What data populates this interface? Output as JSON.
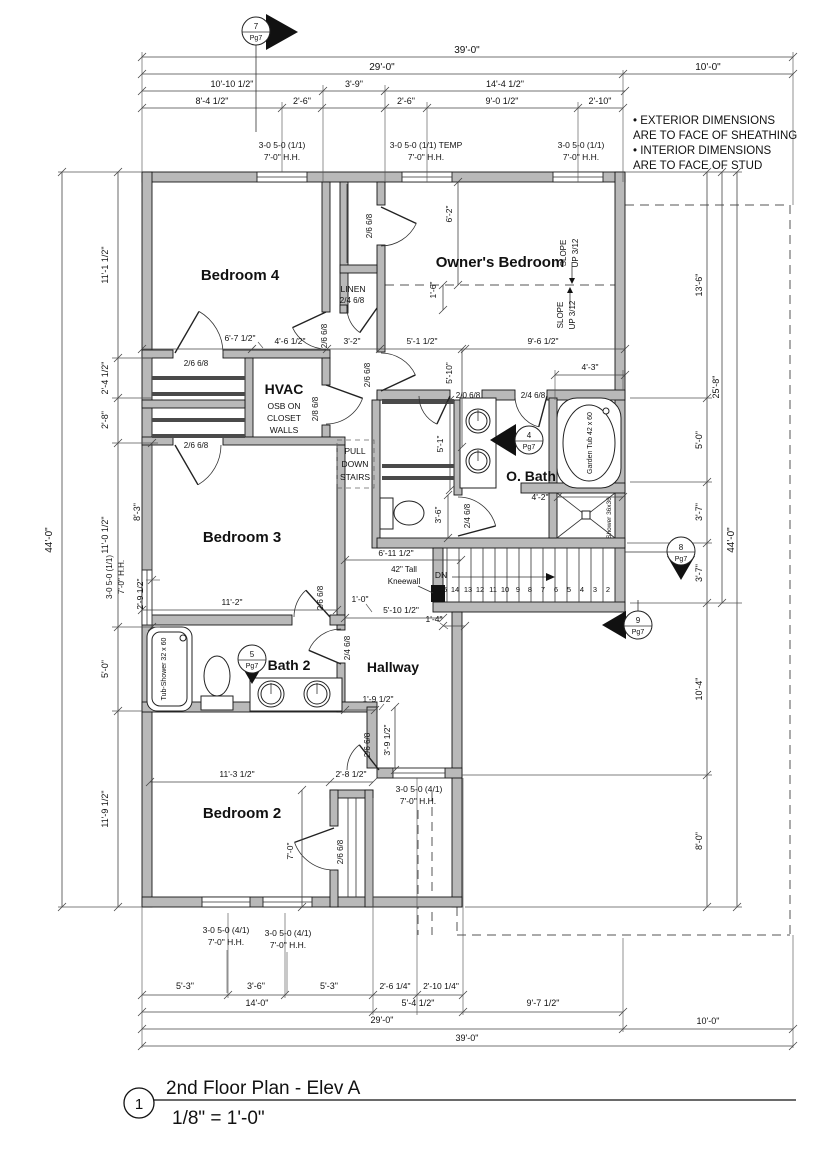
{
  "sheet": {
    "drawing_type": "architectural floor plan",
    "accent_wall_color": "#b9b9b9",
    "line_color": "#222222"
  },
  "labels": {
    "title_block": [
      {
        "n": "detail-number",
        "t": "1",
        "x": 139,
        "y": 1109,
        "s": 15
      },
      {
        "n": "drawing-title",
        "t": "2nd Floor Plan - Elev A",
        "x": 166,
        "y": 1094,
        "s": 19,
        "a": "s"
      },
      {
        "n": "drawing-scale",
        "t": "1/8\" = 1'-0\"",
        "x": 172,
        "y": 1124,
        "s": 19,
        "a": "s"
      }
    ],
    "notes": [
      {
        "n": "note-line",
        "t": "• EXTERIOR DIMENSIONS",
        "x": 633,
        "y": 124,
        "s": 11.5,
        "a": "s"
      },
      {
        "n": "note-line",
        "t": "ARE TO FACE OF SHEATHING",
        "x": 633,
        "y": 139,
        "s": 11.5,
        "a": "s"
      },
      {
        "n": "note-line",
        "t": "• INTERIOR DIMENSIONS",
        "x": 633,
        "y": 154,
        "s": 11.5,
        "a": "s"
      },
      {
        "n": "note-line",
        "t": "ARE TO FACE OF STUD",
        "x": 633,
        "y": 169,
        "s": 11.5,
        "a": "s"
      }
    ],
    "rooms": [
      {
        "n": "room-label-bedroom-4",
        "t": "Bedroom 4",
        "x": 240,
        "y": 280,
        "s": 15,
        "b": 1
      },
      {
        "n": "room-label-owners-bedroom",
        "t": "Owner's Bedroom",
        "x": 500,
        "y": 267,
        "s": 15,
        "b": 1
      },
      {
        "n": "room-label-bedroom-3",
        "t": "Bedroom 3",
        "x": 242,
        "y": 542,
        "s": 15,
        "b": 1
      },
      {
        "n": "room-label-bedroom-2",
        "t": "Bedroom 2",
        "x": 242,
        "y": 818,
        "s": 15,
        "b": 1
      },
      {
        "n": "room-label-owners-bath",
        "t": "O. Bath",
        "x": 531,
        "y": 481,
        "s": 14,
        "b": 1
      },
      {
        "n": "room-label-bath-2",
        "t": "Bath 2",
        "x": 289,
        "y": 670,
        "s": 14,
        "b": 1
      },
      {
        "n": "room-label-hallway",
        "t": "Hallway",
        "x": 393,
        "y": 672,
        "s": 14,
        "b": 1
      },
      {
        "n": "room-label-linen",
        "t": "LINEN",
        "x": 353,
        "y": 292,
        "s": 8.5
      },
      {
        "n": "room-label-hvac",
        "t": "HVAC",
        "x": 284,
        "y": 394,
        "s": 14,
        "b": 1
      },
      {
        "n": "hvac-note",
        "t": "OSB ON",
        "x": 284,
        "y": 409,
        "s": 8.5
      },
      {
        "n": "hvac-note",
        "t": "CLOSET",
        "x": 284,
        "y": 421,
        "s": 8.5
      },
      {
        "n": "hvac-note",
        "t": "WALLS",
        "x": 284,
        "y": 433,
        "s": 8.5
      },
      {
        "n": "pull-down-stairs-note",
        "t": "PULL",
        "x": 355,
        "y": 454,
        "s": 8.5
      },
      {
        "n": "pull-down-stairs-note",
        "t": "DOWN",
        "x": 355,
        "y": 467,
        "s": 8.5
      },
      {
        "n": "pull-down-stairs-note",
        "t": "STAIRS",
        "x": 355,
        "y": 480,
        "s": 8.5
      }
    ],
    "fixtures": [
      {
        "n": "fixture-label-garden-tub",
        "t": "Garden Tub 42 x 60",
        "x": 592,
        "y": 443,
        "r": -90,
        "s": 7
      },
      {
        "n": "fixture-label-shower",
        "t": "Shower 36x36",
        "x": 611,
        "y": 518,
        "r": -90,
        "s": 6.5
      },
      {
        "n": "fixture-label-tub-shower",
        "t": "Tub-Shower 32 x 60",
        "x": 166,
        "y": 669,
        "r": -90,
        "s": 7
      }
    ],
    "dims_top": [
      {
        "n": "dimension-label",
        "t": "39'-0\"",
        "x": 467,
        "y": 53,
        "s": 10
      },
      {
        "n": "dimension-label",
        "t": "29'-0\"",
        "x": 382,
        "y": 70,
        "s": 10
      },
      {
        "n": "dimension-label",
        "t": "10'-0\"",
        "x": 708,
        "y": 70,
        "s": 10
      },
      {
        "n": "dimension-label",
        "t": "10'-10 1/2\"",
        "x": 232,
        "y": 87
      },
      {
        "n": "dimension-label",
        "t": "3'-9\"",
        "x": 354,
        "y": 87
      },
      {
        "n": "dimension-label",
        "t": "14'-4 1/2\"",
        "x": 505,
        "y": 87
      },
      {
        "n": "dimension-label",
        "t": "8'-4 1/2\"",
        "x": 212,
        "y": 104
      },
      {
        "n": "dimension-label",
        "t": "2'-6\"",
        "x": 302,
        "y": 104
      },
      {
        "n": "dimension-label",
        "t": "2'-6\"",
        "x": 406,
        "y": 104
      },
      {
        "n": "dimension-label",
        "t": "9'-0 1/2\"",
        "x": 502,
        "y": 104
      },
      {
        "n": "dimension-label",
        "t": "2'-10\"",
        "x": 600,
        "y": 104
      }
    ],
    "dims_bottom": [
      {
        "n": "dimension-label",
        "t": "5'-3\"",
        "x": 185,
        "y": 989
      },
      {
        "n": "dimension-label",
        "t": "3'-6\"",
        "x": 256,
        "y": 989
      },
      {
        "n": "dimension-label",
        "t": "5'-3\"",
        "x": 329,
        "y": 989
      },
      {
        "n": "dimension-label",
        "t": "2'-6 1/4\"",
        "x": 395,
        "y": 989,
        "s": 8.5
      },
      {
        "n": "dimension-label",
        "t": "2'-10 1/4\"",
        "x": 441,
        "y": 989,
        "s": 8.5
      },
      {
        "n": "dimension-label",
        "t": "14'-0\"",
        "x": 257,
        "y": 1006
      },
      {
        "n": "dimension-label",
        "t": "5'-4 1/2\"",
        "x": 418,
        "y": 1006
      },
      {
        "n": "dimension-label",
        "t": "9'-7 1/2\"",
        "x": 543,
        "y": 1006
      },
      {
        "n": "dimension-label",
        "t": "29'-0\"",
        "x": 382,
        "y": 1023
      },
      {
        "n": "dimension-label",
        "t": "10'-0\"",
        "x": 708,
        "y": 1024
      },
      {
        "n": "dimension-label",
        "t": "39'-0\"",
        "x": 467,
        "y": 1041
      }
    ],
    "dims_left": [
      {
        "n": "dimension-label",
        "t": "44'-0\"",
        "x": 52,
        "y": 540,
        "r": -90,
        "s": 10
      },
      {
        "n": "dimension-label",
        "t": "11'-1 1/2\"",
        "x": 108,
        "y": 265,
        "r": -90
      },
      {
        "n": "dimension-label",
        "t": "2'-4 1/2\"",
        "x": 108,
        "y": 378,
        "r": -90
      },
      {
        "n": "dimension-label",
        "t": "2'-8\"",
        "x": 108,
        "y": 420,
        "r": -90
      },
      {
        "n": "dimension-label",
        "t": "11'-0 1/2\"",
        "x": 108,
        "y": 535,
        "r": -90
      },
      {
        "n": "dimension-label",
        "t": "8'-3\"",
        "x": 140,
        "y": 512,
        "r": -90
      },
      {
        "n": "dimension-label",
        "t": "2'-9 1/2\"",
        "x": 143,
        "y": 594,
        "r": -90,
        "s": 8.5
      },
      {
        "n": "dimension-label",
        "t": "5'-0\"",
        "x": 108,
        "y": 669,
        "r": -90
      },
      {
        "n": "dimension-label",
        "t": "11'-9 1/2\"",
        "x": 108,
        "y": 809,
        "r": -90
      }
    ],
    "dims_right": [
      {
        "n": "dimension-label",
        "t": "13'-6\"",
        "x": 702,
        "y": 285,
        "r": -90
      },
      {
        "n": "dimension-label",
        "t": "25'-8\"",
        "x": 719,
        "y": 387,
        "r": -90
      },
      {
        "n": "dimension-label",
        "t": "44'-0\"",
        "x": 734,
        "y": 540,
        "r": -90,
        "s": 10
      },
      {
        "n": "dimension-label",
        "t": "5'-0\"",
        "x": 702,
        "y": 440,
        "r": -90
      },
      {
        "n": "dimension-label",
        "t": "3'-7\"",
        "x": 702,
        "y": 512,
        "r": -90
      },
      {
        "n": "dimension-label",
        "t": "3'-7\"",
        "x": 702,
        "y": 573,
        "r": -90
      },
      {
        "n": "dimension-label",
        "t": "10'-4\"",
        "x": 702,
        "y": 689,
        "r": -90
      },
      {
        "n": "dimension-label",
        "t": "8'-0\"",
        "x": 702,
        "y": 841,
        "r": -90
      }
    ],
    "dims_interior": [
      {
        "n": "dimension-label",
        "t": "6'-2\"",
        "x": 452,
        "y": 214,
        "r": -90,
        "s": 8.5
      },
      {
        "n": "dimension-label",
        "t": "1'-6\"",
        "x": 436,
        "y": 290,
        "r": -90,
        "s": 8.5
      },
      {
        "n": "dimension-label",
        "t": "6'-7 1/2\"",
        "x": 240,
        "y": 341,
        "s": 8.5
      },
      {
        "n": "dimension-label",
        "t": "4'-6 1/2\"",
        "x": 290,
        "y": 344,
        "s": 8.5
      },
      {
        "n": "dimension-label",
        "t": "3'-2\"",
        "x": 352,
        "y": 344,
        "s": 8.5
      },
      {
        "n": "dimension-label",
        "t": "5'-1 1/2\"",
        "x": 422,
        "y": 344,
        "s": 8.5
      },
      {
        "n": "dimension-label",
        "t": "9'-6 1/2\"",
        "x": 543,
        "y": 344,
        "s": 8.5
      },
      {
        "n": "dimension-label",
        "t": "4'-3\"",
        "x": 590,
        "y": 370,
        "s": 8.5
      },
      {
        "n": "dimension-label",
        "t": "5'-10\"",
        "x": 452,
        "y": 373,
        "r": -90,
        "s": 8.5
      },
      {
        "n": "dimension-label",
        "t": "5'-1\"",
        "x": 443,
        "y": 444,
        "r": -90,
        "s": 8.5
      },
      {
        "n": "dimension-label",
        "t": "3'-6\"",
        "x": 441,
        "y": 515,
        "r": -90,
        "s": 8.5
      },
      {
        "n": "dimension-label",
        "t": "4'-2\"",
        "x": 540,
        "y": 500,
        "s": 8.5
      },
      {
        "n": "dimension-label",
        "t": "11'-2\"",
        "x": 232,
        "y": 605,
        "s": 8.5
      },
      {
        "n": "dimension-label",
        "t": "1'-0\"",
        "x": 360,
        "y": 602,
        "s": 8.5
      },
      {
        "n": "dimension-label",
        "t": "5'-10 1/2\"",
        "x": 401,
        "y": 613,
        "s": 8.5
      },
      {
        "n": "dimension-label",
        "t": "1'-4\"",
        "x": 434,
        "y": 622,
        "s": 8.5
      },
      {
        "n": "dimension-label",
        "t": "6'-11 1/2\"",
        "x": 396,
        "y": 556,
        "s": 8.5
      },
      {
        "n": "dimension-label",
        "t": "1'-9 1/2\"",
        "x": 378,
        "y": 702,
        "s": 8.5
      },
      {
        "n": "dimension-label",
        "t": "3'-9 1/2\"",
        "x": 390,
        "y": 740,
        "r": -90,
        "s": 8.5
      },
      {
        "n": "dimension-label",
        "t": "2'-8 1/2\"",
        "x": 351,
        "y": 777,
        "s": 8.5
      },
      {
        "n": "dimension-label",
        "t": "11'-3 1/2\"",
        "x": 237,
        "y": 777,
        "s": 8.5
      },
      {
        "n": "dimension-label",
        "t": "7'-0\"",
        "x": 293,
        "y": 851,
        "r": -90,
        "s": 8.5
      }
    ],
    "window_tags": [
      {
        "n": "window-tag",
        "t": "3-0 5-0 (1/1)",
        "x": 282,
        "y": 148,
        "s": 8.5
      },
      {
        "n": "window-tag",
        "t": "7'-0\" H.H.",
        "x": 282,
        "y": 160,
        "s": 8.5
      },
      {
        "n": "window-tag",
        "t": "3-0 5-0 (1/1) TEMP",
        "x": 426,
        "y": 148,
        "s": 8.5
      },
      {
        "n": "window-tag",
        "t": "7'-0\" H.H.",
        "x": 426,
        "y": 160,
        "s": 8.5
      },
      {
        "n": "window-tag",
        "t": "3-0 5-0 (1/1)",
        "x": 581,
        "y": 148,
        "s": 8.5
      },
      {
        "n": "window-tag",
        "t": "7'-0\" H.H.",
        "x": 581,
        "y": 160,
        "s": 8.5
      },
      {
        "n": "window-tag",
        "t": "3-0 5-0 (1/1)",
        "x": 112,
        "y": 577,
        "r": -90,
        "s": 8
      },
      {
        "n": "window-tag",
        "t": "7'-0\" H.H.",
        "x": 124,
        "y": 577,
        "r": -90,
        "s": 8
      },
      {
        "n": "window-tag",
        "t": "3-0 5-0 (4/1)",
        "x": 226,
        "y": 933,
        "s": 8.5
      },
      {
        "n": "window-tag",
        "t": "7'-0\" H.H.",
        "x": 226,
        "y": 945,
        "s": 8.5
      },
      {
        "n": "window-tag",
        "t": "3-0 5-0 (4/1)",
        "x": 288,
        "y": 936,
        "s": 8.5
      },
      {
        "n": "window-tag",
        "t": "7'-0\" H.H.",
        "x": 288,
        "y": 948,
        "s": 8.5
      },
      {
        "n": "window-tag",
        "t": "3-0 5-0 (4/1)",
        "x": 419,
        "y": 792,
        "s": 8.5
      },
      {
        "n": "window-tag",
        "t": "7'-0\" H.H.",
        "x": 418,
        "y": 804,
        "s": 8.5
      }
    ],
    "door_tags": [
      {
        "n": "door-tag",
        "t": "2/6 6/8",
        "x": 196,
        "y": 366,
        "s": 8
      },
      {
        "n": "door-tag",
        "t": "2/6 6/8",
        "x": 196,
        "y": 448,
        "s": 8
      },
      {
        "n": "door-tag",
        "t": "2/6 6/8",
        "x": 327,
        "y": 336,
        "r": -90,
        "s": 8
      },
      {
        "n": "door-tag",
        "t": "2/6 6/8",
        "x": 372,
        "y": 226,
        "r": -90,
        "s": 8
      },
      {
        "n": "door-tag",
        "t": "2/6 6/8",
        "x": 370,
        "y": 375,
        "r": -90,
        "s": 8
      },
      {
        "n": "door-tag",
        "t": "2/8 6/8",
        "x": 318,
        "y": 409,
        "r": -90,
        "s": 8
      },
      {
        "n": "door-tag",
        "t": "2/4 6/8",
        "x": 352,
        "y": 303,
        "s": 8
      },
      {
        "n": "door-tag",
        "t": "2/0 6/8",
        "x": 468,
        "y": 398,
        "s": 8
      },
      {
        "n": "door-tag",
        "t": "2/4 6/8",
        "x": 533,
        "y": 398,
        "s": 8
      },
      {
        "n": "door-tag",
        "t": "2/4 6/8",
        "x": 470,
        "y": 516,
        "r": -90,
        "s": 8
      },
      {
        "n": "door-tag",
        "t": "2/6 6/8",
        "x": 323,
        "y": 598,
        "r": -90,
        "s": 8
      },
      {
        "n": "door-tag",
        "t": "2/4 6/8",
        "x": 350,
        "y": 648,
        "r": -90,
        "s": 8
      },
      {
        "n": "door-tag",
        "t": "2/6 6/8",
        "x": 370,
        "y": 745,
        "r": -90,
        "s": 8
      },
      {
        "n": "door-tag",
        "t": "2/6 6/8",
        "x": 343,
        "y": 852,
        "r": -90,
        "s": 8
      }
    ],
    "stairs": [
      {
        "n": "stairs-dn-label",
        "t": "DN",
        "x": 441,
        "y": 578,
        "s": 8.5
      },
      {
        "n": "kneewall-note",
        "t": "42\" Tall",
        "x": 404,
        "y": 572,
        "s": 8
      },
      {
        "n": "kneewall-note",
        "t": "Kneewall",
        "x": 404,
        "y": 584,
        "s": 8
      },
      {
        "n": "stair-tread-number",
        "t": "15",
        "x": 443,
        "y": 592,
        "s": 7.5
      },
      {
        "n": "stair-tread-number",
        "t": "14",
        "x": 455,
        "y": 592,
        "s": 7.5
      },
      {
        "n": "stair-tread-number",
        "t": "13",
        "x": 468,
        "y": 592,
        "s": 7.5
      },
      {
        "n": "stair-tread-number",
        "t": "12",
        "x": 480,
        "y": 592,
        "s": 7.5
      },
      {
        "n": "stair-tread-number",
        "t": "11",
        "x": 493,
        "y": 592,
        "s": 7.5
      },
      {
        "n": "stair-tread-number",
        "t": "10",
        "x": 505,
        "y": 592,
        "s": 7.5
      },
      {
        "n": "stair-tread-number",
        "t": "9",
        "x": 518,
        "y": 592,
        "s": 7.5
      },
      {
        "n": "stair-tread-number",
        "t": "8",
        "x": 530,
        "y": 592,
        "s": 7.5
      },
      {
        "n": "stair-tread-number",
        "t": "7",
        "x": 543,
        "y": 592,
        "s": 7.5
      },
      {
        "n": "stair-tread-number",
        "t": "6",
        "x": 556,
        "y": 592,
        "s": 7.5
      },
      {
        "n": "stair-tread-number",
        "t": "5",
        "x": 569,
        "y": 592,
        "s": 7.5
      },
      {
        "n": "stair-tread-number",
        "t": "4",
        "x": 582,
        "y": 592,
        "s": 7.5
      },
      {
        "n": "stair-tread-number",
        "t": "3",
        "x": 595,
        "y": 592,
        "s": 7.5
      },
      {
        "n": "stair-tread-number",
        "t": "2",
        "x": 608,
        "y": 592,
        "s": 7.5
      }
    ],
    "slope": [
      {
        "n": "slope-note",
        "t": "SLOPE",
        "x": 566,
        "y": 253,
        "r": -90,
        "s": 8
      },
      {
        "n": "slope-note",
        "t": "UP 3/12",
        "x": 578,
        "y": 253,
        "r": -90,
        "s": 8
      },
      {
        "n": "slope-note",
        "t": "SLOPE",
        "x": 563,
        "y": 315,
        "r": -90,
        "s": 8
      },
      {
        "n": "slope-note",
        "t": "UP 3/12",
        "x": 575,
        "y": 315,
        "r": -90,
        "s": 8
      }
    ],
    "markers": [
      {
        "n": "detail-marker-number",
        "t": "7",
        "x": 256,
        "y": 29,
        "s": 8
      },
      {
        "n": "detail-marker-page",
        "t": "Pg7",
        "x": 256,
        "y": 40,
        "s": 7
      },
      {
        "n": "detail-marker-number",
        "t": "4",
        "x": 529,
        "y": 438,
        "s": 8
      },
      {
        "n": "detail-marker-page",
        "t": "Pg7",
        "x": 529,
        "y": 449,
        "s": 7
      },
      {
        "n": "detail-marker-number",
        "t": "5",
        "x": 252,
        "y": 657,
        "s": 8
      },
      {
        "n": "detail-marker-page",
        "t": "Pg7",
        "x": 252,
        "y": 668,
        "s": 7
      },
      {
        "n": "detail-marker-number",
        "t": "8",
        "x": 681,
        "y": 550,
        "s": 8
      },
      {
        "n": "detail-marker-page",
        "t": "Pg7",
        "x": 681,
        "y": 561,
        "s": 7
      },
      {
        "n": "detail-marker-number",
        "t": "9",
        "x": 638,
        "y": 623,
        "s": 8
      },
      {
        "n": "detail-marker-page",
        "t": "Pg7",
        "x": 638,
        "y": 634,
        "s": 7
      }
    ]
  }
}
